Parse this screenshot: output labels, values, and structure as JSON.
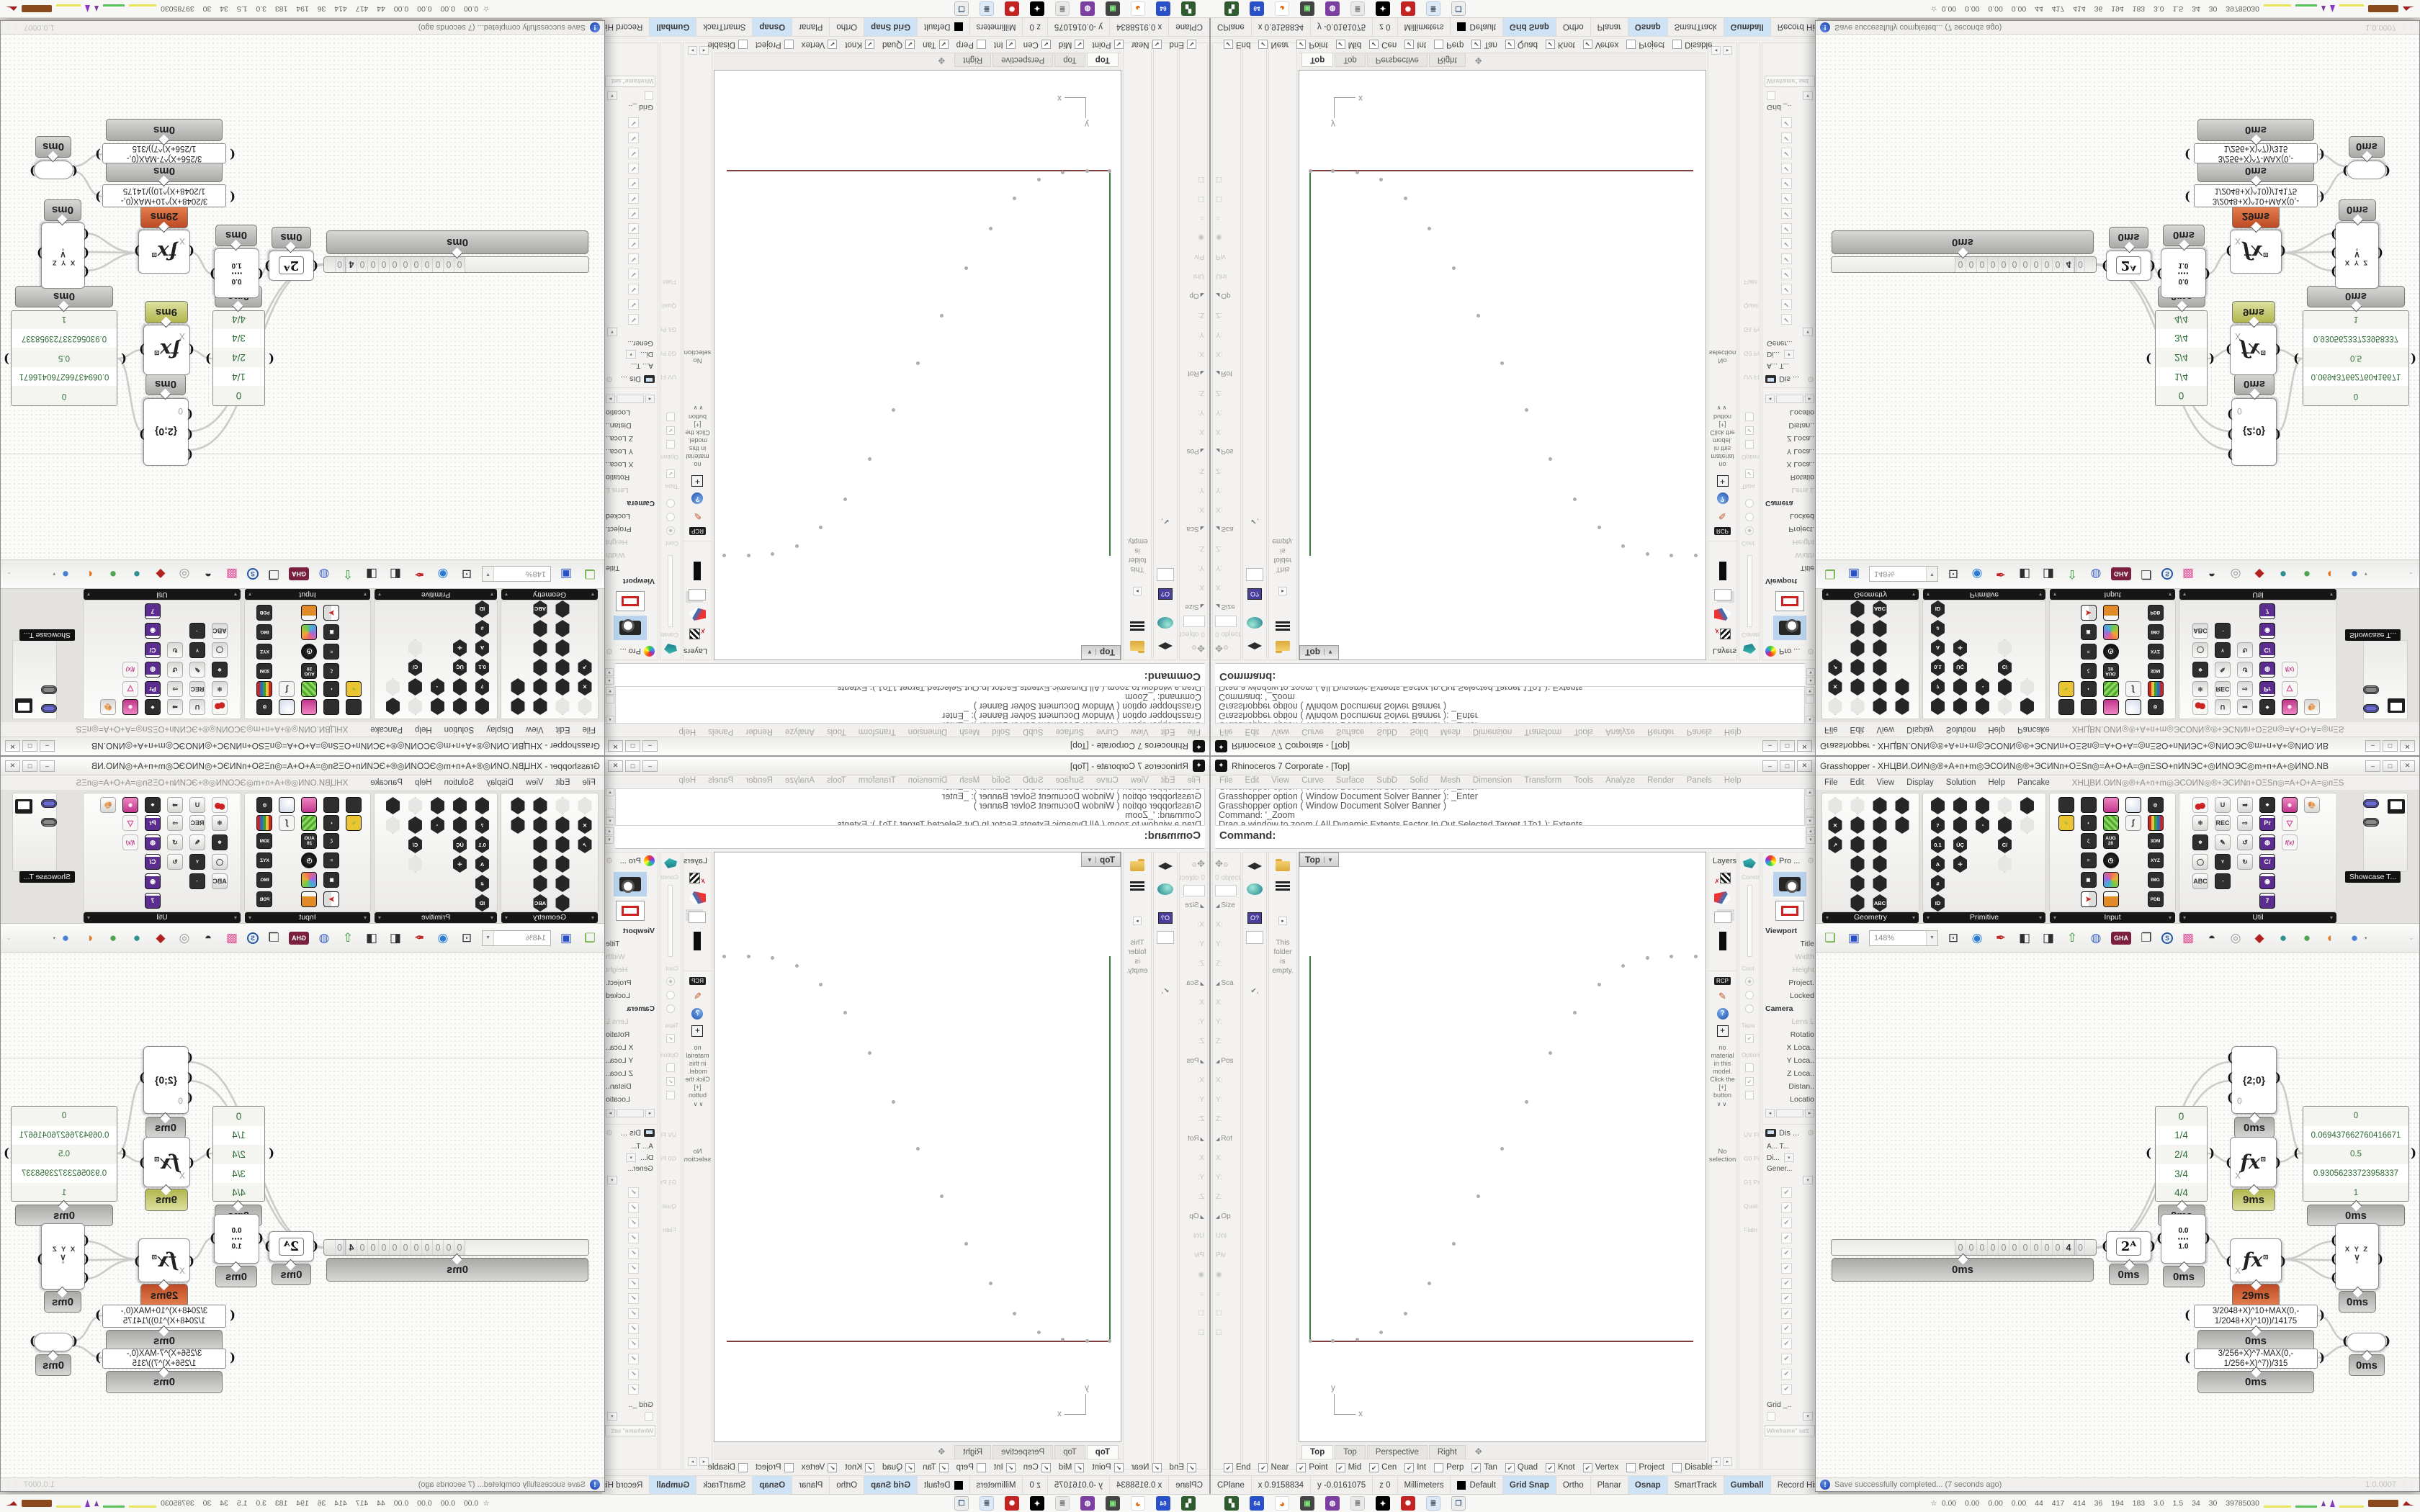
{
  "rhino": {
    "title": "Rhinoceros 7 Corporate - [Top]",
    "win_buttons": [
      "–",
      "□",
      "✕"
    ],
    "menu": [
      "File",
      "Edit",
      "View",
      "Curve",
      "Surface",
      "SubD",
      "Solid",
      "Mesh",
      "Dimension",
      "Transform",
      "Tools",
      "Analyze",
      "Render",
      "Panels",
      "Help"
    ],
    "command_history": [
      "Grasshopper option ( Window  Document  Solver  Banner ):  _Enter",
      "Grasshopper option ( Window  Document  Solver  Banner ):  _Enter",
      "Grasshopper option ( Window  Document  Solver  Banner )",
      "Command: '_Zoom",
      "Drag a window to zoom ( All  Dynamic  Extents  Factor  In  Out  Selected  Target  1To1 ):  Extents"
    ],
    "command_prompt": "Command:",
    "boxedit_header": "0 objects",
    "boxedit_rows": [
      {
        "t": "Size",
        "c": "sec"
      },
      {
        "t": "X:"
      },
      {
        "t": "Y:"
      },
      {
        "t": "Z:"
      },
      {
        "t": "Sca",
        "c": "sec"
      },
      {
        "t": "X:"
      },
      {
        "t": "Y:"
      },
      {
        "t": "Z:"
      },
      {
        "t": "Pos",
        "c": "sec"
      },
      {
        "t": "X:"
      },
      {
        "t": "Y:"
      },
      {
        "t": "Z:"
      },
      {
        "t": "Rot",
        "c": "sec"
      },
      {
        "t": "X:"
      },
      {
        "t": "Y:"
      },
      {
        "t": "Z:"
      },
      {
        "t": "Op",
        "c": "sec"
      },
      {
        "t": "Uni"
      },
      {
        "t": "Piv"
      },
      {
        "t": "◉"
      },
      {
        "t": "○"
      },
      {
        "t": "☐"
      },
      {
        "t": "☐"
      }
    ],
    "libraries_text": "This folder is empty.",
    "layers_title": "Layers",
    "materials": {
      "rcp": "RCP",
      "message": "no material in this model. Click the [+] button",
      "more": "∨∨",
      "selection": "No selection"
    },
    "colB_top": [
      "Constra",
      "Cont",
      "Tapa",
      "Option"
    ],
    "colB_bottom": [
      "UV Fl",
      "G0 Pr",
      "G1 Pr",
      "Quali",
      "Flatn"
    ],
    "properties_header": "Pro ...",
    "properties_rows": [
      {
        "t": "Viewport",
        "c": "sec"
      },
      {
        "t": "Title"
      },
      {
        "t": "Width",
        "c": "dim"
      },
      {
        "t": "Height",
        "c": "dim"
      },
      {
        "t": "Project."
      },
      {
        "t": "Locked"
      },
      {
        "t": "Camera",
        "c": "sec"
      },
      {
        "t": "Lens L",
        "c": "dim"
      },
      {
        "t": "Rotatio"
      },
      {
        "t": "X Loca.."
      },
      {
        "t": "Y Loca.."
      },
      {
        "t": "Z Loca.."
      },
      {
        "t": "Distan.."
      },
      {
        "t": "Locatio"
      }
    ],
    "display_header": "Dis ...",
    "display_rows": [
      "A...  T...",
      "Di...",
      "Gener..."
    ],
    "display_checks": [
      "✔",
      "✔",
      "✔",
      "✔",
      "✔",
      "✔",
      "✔",
      "✔",
      "✔",
      "✔",
      "✔",
      "✔",
      "✔",
      "✔"
    ],
    "display_grid": "Grid _..",
    "display_wireframe": "Wireframe\" sett",
    "viewport": {
      "label": "Top",
      "points": [
        [
          483,
          146
        ],
        [
          516,
          144
        ],
        [
          550,
          144
        ],
        [
          449,
          157
        ],
        [
          416,
          183
        ],
        [
          382,
          222
        ],
        [
          348,
          278
        ],
        [
          315,
          346
        ],
        [
          281,
          411
        ],
        [
          248,
          477
        ],
        [
          214,
          543
        ],
        [
          180,
          598
        ],
        [
          147,
          640
        ],
        [
          113,
          666
        ],
        [
          80,
          676
        ],
        [
          46,
          678
        ],
        [
          15,
          678
        ]
      ],
      "axis_y_label": "y",
      "axis_x_label": "x"
    },
    "viewport_tabs": [
      {
        "t": "Top",
        "c": "act"
      },
      {
        "t": "Top"
      },
      {
        "t": "Perspective"
      },
      {
        "t": "Right"
      },
      {
        "t": "✥",
        "c": "plus"
      }
    ],
    "osnap": [
      {
        "label": "End",
        "mark": "✔"
      },
      {
        "label": "Near",
        "mark": "✔"
      },
      {
        "label": "Point",
        "mark": "✔"
      },
      {
        "label": "Mid",
        "mark": "✔"
      },
      {
        "label": "Cen",
        "mark": "✔"
      },
      {
        "label": "Int",
        "mark": "✔"
      },
      {
        "label": "Perp",
        "mark": ""
      },
      {
        "label": "Tan",
        "mark": "✔"
      },
      {
        "label": "Quad",
        "mark": "✔"
      },
      {
        "label": "Knot",
        "mark": "✔"
      },
      {
        "label": "Vertex",
        "mark": "✔"
      },
      {
        "label": "Project",
        "mark": ""
      },
      {
        "label": "Disable",
        "mark": ""
      }
    ],
    "statusbar": [
      {
        "t": "CPlane"
      },
      {
        "t": "x 0.9158834"
      },
      {
        "t": "y -0.0161075"
      },
      {
        "t": "z 0"
      },
      {
        "t": "Millimeters"
      },
      {
        "t": "Default",
        "c": "sw"
      },
      {
        "t": "Grid Snap",
        "c": "on"
      },
      {
        "t": "Ortho"
      },
      {
        "t": "Planar"
      },
      {
        "t": "Osnap",
        "c": "on"
      },
      {
        "t": "SmartTrack"
      },
      {
        "t": "Gumball",
        "c": "on"
      },
      {
        "t": "Record History"
      },
      {
        "t": "Filter"
      }
    ]
  },
  "gh": {
    "title": "Grasshopper - XHЦBИ.OИN◎®+A+п+m◎ЭCOИN◎®+ЭCИNп+OΞЅп◎=A+O+A=◎пΞЅO+пИNЭC+◎ИNOЭC◎m+п+A+◎ИNO.NB",
    "win_buttons": [
      "–",
      "□",
      "✕"
    ],
    "menu": [
      "File",
      "Edit",
      "View",
      "Display",
      "Solution",
      "Help",
      "Pancake"
    ],
    "menu_doc": "XHЦBИ.OИN◎®+A+п+m◎ЭCOИN◎®+ЭCИNп+OΞЅп◎=A+O+A=◎пΞЅ",
    "tab_glyphs": [
      "Σ",
      "Ψ",
      "↗",
      "↻",
      "◆",
      "▼",
      "✖",
      "Ϛ",
      "◉",
      "A",
      "✿",
      "A",
      "B",
      "▲",
      "B",
      "▣",
      "♞",
      "D",
      "E",
      "E",
      "E",
      "F",
      "✳",
      "✳",
      "✎",
      "G",
      "G"
    ],
    "palette_captions": [
      "Geometry",
      "Primitive",
      "Input",
      "Util"
    ],
    "showcase_tooltip": "Showcase T...",
    "pal_geometry": [
      {
        "c": "hx lt"
      },
      {
        "c": "hx lt"
      },
      {
        "c": "hx"
      },
      {
        "c": "hx"
      },
      {
        "c": "hx",
        "t": "✕"
      },
      {
        "c": "hx"
      },
      {
        "c": "hx"
      },
      {
        "c": "hx"
      },
      {
        "c": "hx",
        "t": "↗"
      },
      {
        "c": "hx"
      },
      {
        "c": "hx"
      },
      {
        "c": "blank"
      },
      {
        "c": "blank"
      },
      {
        "c": "hx"
      },
      {
        "c": "hx"
      },
      {
        "c": "blank"
      },
      {
        "c": "blank"
      },
      {
        "c": "hx"
      },
      {
        "c": "hx"
      },
      {
        "c": "blank"
      },
      {
        "c": "blank"
      },
      {
        "c": "hx"
      },
      {
        "c": "hx",
        "t": "ABC"
      },
      {
        "c": "blank"
      }
    ],
    "pal_primitive": [
      {
        "c": "hx"
      },
      {
        "c": "hx"
      },
      {
        "c": "hx"
      },
      {
        "c": "hx lt"
      },
      {
        "c": "hx"
      },
      {
        "c": "hx",
        "t": "7"
      },
      {
        "c": "hx"
      },
      {
        "c": "hx",
        "t": "◔"
      },
      {
        "c": "hx"
      },
      {
        "c": "hx lt"
      },
      {
        "c": "hx",
        "t": "0.1"
      },
      {
        "c": "hx",
        "t": "ÜÇ"
      },
      {
        "c": "blank"
      },
      {
        "c": "hx",
        "t": "C/"
      },
      {
        "c": "blank"
      },
      {
        "c": "hx",
        "t": "A"
      },
      {
        "c": "hx",
        "t": "✛"
      },
      {
        "c": "blank"
      },
      {
        "c": "hx lt"
      },
      {
        "c": "blank"
      },
      {
        "c": "hx",
        "t": "#"
      },
      {
        "c": "blank"
      },
      {
        "c": "blank"
      },
      {
        "c": "blank"
      },
      {
        "c": "blank"
      },
      {
        "c": "hx",
        "t": "ID"
      },
      {
        "c": "blank"
      },
      {
        "c": "blank"
      },
      {
        "c": "blank"
      },
      {
        "c": "blank"
      }
    ],
    "pal_input": [
      {
        "c": "sq"
      },
      {
        "c": "sq"
      },
      {
        "c": "sq pink"
      },
      {
        "c": "sq ball"
      },
      {
        "c": "sq",
        "t": "◎"
      },
      {
        "c": "sq yellow",
        "t": "∿"
      },
      {
        "c": "sq",
        "t": "◖"
      },
      {
        "c": "sq green"
      },
      {
        "c": "sq curve",
        "t": "∫"
      },
      {
        "c": "sq bars"
      },
      {
        "c": "blank"
      },
      {
        "c": "sq",
        "t": "ζ"
      },
      {
        "c": "sq",
        "t": "AUG 20"
      },
      {
        "c": "blank"
      },
      {
        "c": "sq",
        "t": "3DM"
      },
      {
        "c": "blank"
      },
      {
        "c": "sq",
        "t": "≡"
      },
      {
        "c": "sq clock",
        "t": "◷"
      },
      {
        "c": "blank"
      },
      {
        "c": "sq",
        "t": "XYZ"
      },
      {
        "c": "blank"
      },
      {
        "c": "sq",
        "t": "▣"
      },
      {
        "c": "sq cube"
      },
      {
        "c": "blank"
      },
      {
        "c": "sq",
        "t": "IMG"
      },
      {
        "c": "blank"
      },
      {
        "c": "sq quad",
        "t": "➤"
      },
      {
        "c": "sq honey"
      },
      {
        "c": "blank"
      },
      {
        "c": "sq",
        "t": "PDB"
      }
    ],
    "pal_util": [
      {
        "c": "sq cherry"
      },
      {
        "c": "sq lt",
        "t": "U"
      },
      {
        "c": "sq lt",
        "t": "➡"
      },
      {
        "c": "sq",
        "t": "❖"
      },
      {
        "c": "sq pink",
        "t": "◉"
      },
      {
        "c": "sq lt",
        "t": "🎨"
      },
      {
        "c": "sq lt",
        "t": "⚛"
      },
      {
        "c": "sq lt",
        "t": "REC"
      },
      {
        "c": "sq lt",
        "t": "⇨"
      },
      {
        "c": "sq pr",
        "t": "Pr"
      },
      {
        "c": "sq flask",
        "t": "▽"
      },
      {
        "c": "blank"
      },
      {
        "c": "sq",
        "t": "❄"
      },
      {
        "c": "sq lt",
        "t": "✎"
      },
      {
        "c": "sq lt",
        "t": "↺"
      },
      {
        "c": "sq pr",
        "t": "◍"
      },
      {
        "c": "sq fx",
        "t": "f(x)"
      },
      {
        "c": "blank"
      },
      {
        "c": "sq lt",
        "t": "◯"
      },
      {
        "c": "sq",
        "t": "Y"
      },
      {
        "c": "sq lt",
        "t": "↻"
      },
      {
        "c": "sq pr",
        "t": "C/"
      },
      {
        "c": "blank"
      },
      {
        "c": "blank"
      },
      {
        "c": "sq lt",
        "t": "ABC"
      },
      {
        "c": "sq",
        "t": "◔"
      },
      {
        "c": "blank"
      },
      {
        "c": "sq pr",
        "t": "◉"
      },
      {
        "c": "blank"
      },
      {
        "c": "blank"
      },
      {
        "c": "blank"
      },
      {
        "c": "blank"
      },
      {
        "c": "blank"
      },
      {
        "c": "sq pr",
        "t": "7"
      },
      {
        "c": "blank"
      },
      {
        "c": "blank"
      }
    ],
    "toolbar_zoom": "148%",
    "toolbar_icons": [
      {
        "t": "❏",
        "c": "g-green"
      },
      {
        "t": "▣",
        "c": "g-blue"
      }
    ],
    "toolbar_icons2": [
      {
        "t": "⊡",
        "c": "g-dark"
      },
      {
        "t": "◉",
        "c": "g-blue2"
      },
      {
        "t": "✒",
        "c": "g-red"
      },
      {
        "t": "◧",
        "c": "g-dark"
      },
      {
        "t": "◨",
        "c": "g-dark"
      },
      {
        "t": "⇧",
        "c": "g-green2"
      },
      {
        "t": "◍",
        "c": "g-blue3"
      },
      {
        "t": "GHA",
        "c": "g-gha"
      },
      {
        "t": "❐",
        "c": "g-dark"
      },
      {
        "t": "S",
        "c": "g-find"
      },
      {
        "t": "▩",
        "c": "g-pink"
      },
      {
        "t": "◓",
        "c": "g-dark"
      },
      {
        "t": "◎",
        "c": "g-gray"
      },
      {
        "t": "◆",
        "c": "g-jewel"
      },
      {
        "t": "●",
        "c": "g-teal"
      },
      {
        "t": "●",
        "c": "g-ball-green"
      },
      {
        "t": "◐",
        "c": "g-orangeball"
      },
      {
        "t": "●",
        "c": "g-blueball"
      }
    ],
    "status_message": "Save successfully completed... (7 seconds ago)",
    "status_icon": "!",
    "version": "1.0.0007",
    "nodes": {
      "t0": "0ms",
      "t9": "9ms",
      "t29": "29ms",
      "n20_label": "{2;0}",
      "n20_input": "0",
      "fractions": [
        "0",
        "1/4",
        "2/4",
        "3/4",
        "4/4"
      ],
      "values": [
        "0",
        "0.069437662760416671",
        "0.5",
        "0.93056233723958337",
        "1"
      ],
      "expr1": "3/2048+X)^10+MAX(0,- 1/2048+X)^10))/14175",
      "expr2": "3/256+X)^7-MAX(0,- 1/256+X)^7))/315",
      "fx_glyph": "fx",
      "fx_sup": "⊡",
      "fx_input": "X",
      "pow2_label": "2ᴬ",
      "range_top": "0.0",
      "range_squares": "▪▪▪▪",
      "range_bottom": "1.0",
      "xyz_r1": "X Y Z",
      "xyz_r2": "∨",
      "xyz_r3": "°",
      "slider_digits": [
        "0",
        "0",
        "0",
        "0",
        "0",
        "0",
        "0",
        "0",
        "0",
        "0",
        "4",
        "0"
      ]
    },
    "wires": [
      "M390,409 C398,409 396,407 403,407",
      "M466,407 C474,407 471,396 479,396",
      "M542,396 C560,396 557,427 575,427",
      "M544,279 C560,279 560,291 575,291",
      "M390,410 C492,410 480,152 577,152",
      "M390,410 C496,410 484,178 577,178",
      "M640,177 C660,177 657,279 676,279",
      "M640,291 C660,291 658,279 676,279",
      "M647,426 C682,426 687,401 721,401",
      "M647,426 C684,426 688,427 721,427",
      "M647,426 C690,426 692,453 721,453",
      "M697,504 C718,504 716,539 737,539",
      "M697,563 C716,563 717,546 737,546"
    ]
  },
  "taskbar_icons": [
    {
      "t": "▚",
      "c": "t-green"
    },
    {
      "t": "64",
      "c": "t-blue"
    },
    {
      "t": "◕",
      "c": "t-fox"
    },
    {
      "t": "▣",
      "c": "t-mon"
    },
    {
      "t": "◍",
      "c": "t-purp"
    },
    {
      "t": "≣",
      "c": "t-note"
    },
    {
      "t": "✦",
      "c": "t-rhino"
    },
    {
      "t": "✺",
      "c": "t-red"
    },
    {
      "t": "≣",
      "c": "t-note2"
    },
    {
      "t": "❐",
      "c": "t-win"
    }
  ],
  "tray": {
    "icon": "☆",
    "numbers": "0.00 0.00 0.00 0.00  44  417  414  36  194  183  3.0  1.5  34  30  39785030"
  }
}
